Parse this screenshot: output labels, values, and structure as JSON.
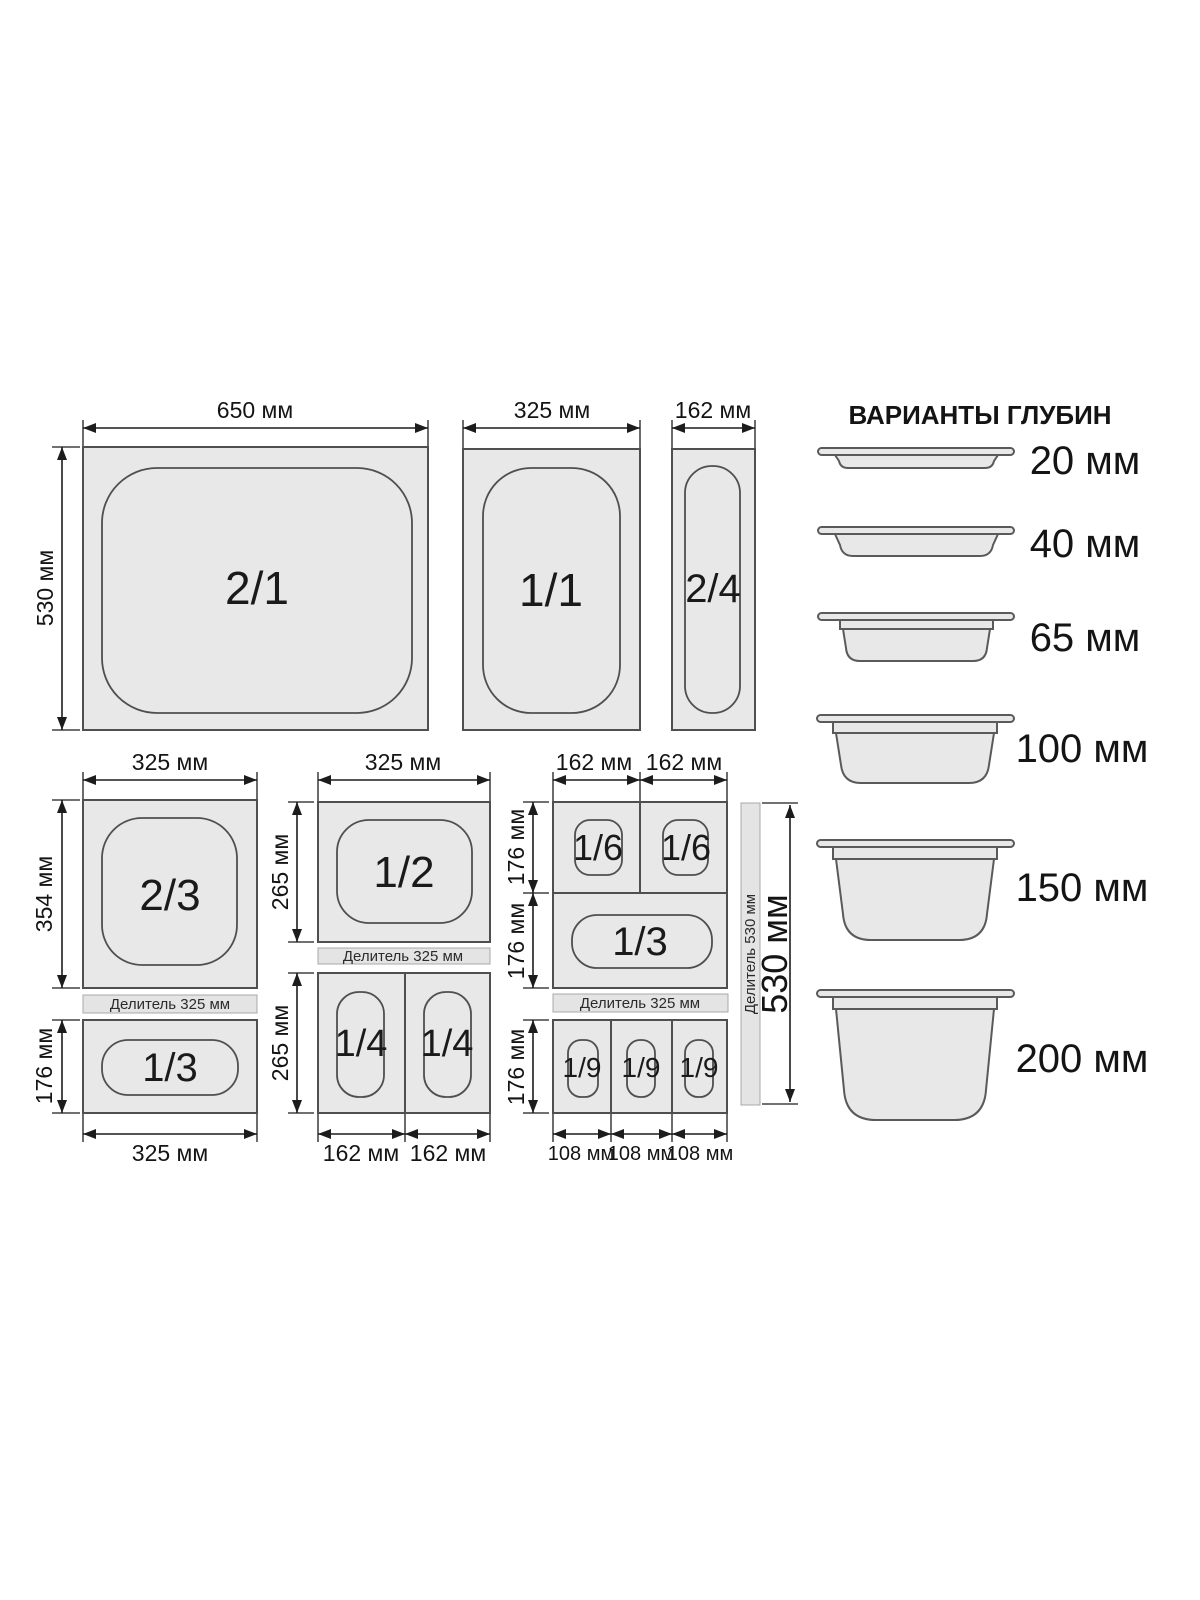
{
  "top_row": {
    "pan_2_1": "2/1",
    "pan_1_1": "1/1",
    "pan_2_4": "2/4",
    "dim_650": "650 мм",
    "dim_325": "325 мм",
    "dim_162": "162 мм",
    "dim_530": "530 мм"
  },
  "left_group": {
    "dim_top": "325 мм",
    "dim_354": "354 мм",
    "pan_2_3": "2/3",
    "divider": "Делитель 325 мм",
    "dim_176": "176 мм",
    "pan_1_3": "1/3",
    "dim_bottom": "325 мм"
  },
  "middle_group": {
    "dim_top": "325 мм",
    "dim_265_top": "265 мм",
    "pan_1_2": "1/2",
    "divider": "Делитель 325 мм",
    "dim_265_bottom": "265 мм",
    "pan_1_4_left": "1/4",
    "pan_1_4_right": "1/4",
    "dim_162_left": "162 мм",
    "dim_162_right": "162 мм"
  },
  "right_group": {
    "dim_162_left": "162 мм",
    "dim_162_right": "162 мм",
    "dim_176_top": "176 мм",
    "dim_176_mid": "176 мм",
    "dim_176_bottom": "176 мм",
    "pan_1_6_left": "1/6",
    "pan_1_6_right": "1/6",
    "pan_1_3": "1/3",
    "divider": "Делитель 325 мм",
    "pan_1_9_1": "1/9",
    "pan_1_9_2": "1/9",
    "pan_1_9_3": "1/9",
    "dim_108_1": "108 мм",
    "dim_108_2": "108 мм",
    "dim_108_3": "108 мм",
    "vertical_divider": "Делитель 530 мм",
    "dim_530": "530 мм"
  },
  "depth_options": {
    "title": "ВАРИАНТЫ ГЛУБИН",
    "items": [
      "20 мм",
      "40 мм",
      "65 мм",
      "100 мм",
      "150 мм",
      "200 мм"
    ]
  },
  "colors": {
    "pan_fill": "#e8e8e8",
    "pan_stroke": "#4f4f4f",
    "dimension": "#1c1c1c",
    "divider_fill": "#e4e4e4"
  }
}
